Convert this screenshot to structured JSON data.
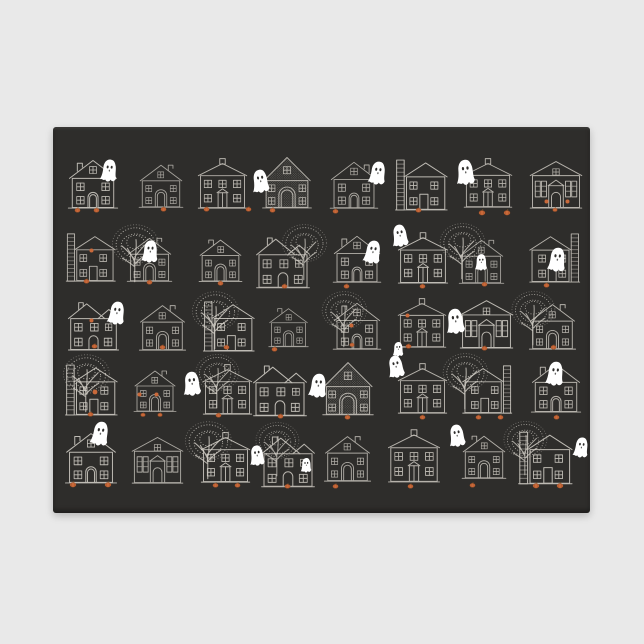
{
  "meta": {
    "description": "Product photo of a dark charcoal rectangular doormat on a light gray background, printed with a Halloween pattern: five rows of white sketched houses, bare speckled trees, white ghosts and orange pumpkins at the doorsteps."
  },
  "colors": {
    "page_bg": "#e9e9e9",
    "rug": "#2e2d2b",
    "line": "#d8d4cc",
    "ghost": "#ffffff",
    "eye": "#2e2d2b",
    "pumpkin": "#c9693a",
    "pumpkin_dark": "#8a4520",
    "stem": "#6e4f2e"
  },
  "rug": {
    "left": 53,
    "top": 127,
    "width": 537,
    "height": 386
  },
  "scene": {
    "width": 537,
    "height": 386,
    "items": [
      {
        "t": "houseA",
        "x": 12,
        "y": 29,
        "s": 56,
        "o": 0.85
      },
      {
        "t": "houseG",
        "x": 82,
        "y": 32,
        "s": 52,
        "o": 0.7
      },
      {
        "t": "houseB",
        "x": 142,
        "y": 30,
        "s": 55,
        "o": 0.8
      },
      {
        "t": "houseC",
        "x": 205,
        "y": 27,
        "s": 58,
        "o": 0.8
      },
      {
        "t": "houseA",
        "x": 274,
        "y": 31,
        "s": 54,
        "o": 0.75,
        "flip": true
      },
      {
        "t": "houseD",
        "x": 339,
        "y": 29,
        "s": 58,
        "o": 0.85
      },
      {
        "t": "houseB",
        "x": 408,
        "y": 30,
        "s": 54,
        "o": 0.8
      },
      {
        "t": "houseE",
        "x": 475,
        "y": 29,
        "s": 56,
        "o": 0.8
      },
      {
        "t": "pumpkin",
        "x": 21,
        "y": 80,
        "s": 7
      },
      {
        "t": "pumpkin",
        "x": 40,
        "y": 80,
        "s": 7
      },
      {
        "t": "pumpkin",
        "x": 107,
        "y": 79,
        "s": 7
      },
      {
        "t": "pumpkin",
        "x": 150,
        "y": 79,
        "s": 7
      },
      {
        "t": "pumpkin",
        "x": 192,
        "y": 79,
        "s": 7
      },
      {
        "t": "pumpkin",
        "x": 216,
        "y": 80,
        "s": 7
      },
      {
        "t": "pumpkin",
        "x": 279,
        "y": 81,
        "s": 7
      },
      {
        "t": "pumpkin",
        "x": 362,
        "y": 80,
        "s": 7
      },
      {
        "t": "pumpkin",
        "x": 425,
        "y": 82,
        "s": 8
      },
      {
        "t": "pumpkin",
        "x": 450,
        "y": 82,
        "s": 8
      },
      {
        "t": "pumpkin",
        "x": 499,
        "y": 80,
        "s": 6
      },
      {
        "t": "glow",
        "x": 491,
        "y": 72,
        "s": 5
      },
      {
        "t": "glow",
        "x": 512,
        "y": 72,
        "s": 5
      },
      {
        "t": "ghost",
        "x": 45,
        "y": 31,
        "s": 23,
        "rot": 6
      },
      {
        "t": "ghost",
        "x": 196,
        "y": 41,
        "s": 24,
        "rot": -8
      },
      {
        "t": "ghost",
        "x": 313,
        "y": 33,
        "s": 24,
        "rot": 8
      },
      {
        "t": "ghost",
        "x": 400,
        "y": 31,
        "s": 26,
        "rot": -5
      },
      {
        "t": "tree",
        "x": 52,
        "y": 94,
        "s": 62,
        "o": 0.8
      },
      {
        "t": "tree",
        "x": 222,
        "y": 94,
        "s": 60,
        "o": 0.75
      },
      {
        "t": "tree",
        "x": 380,
        "y": 93,
        "s": 60,
        "o": 0.8
      },
      {
        "t": "houseD",
        "x": 10,
        "y": 103,
        "s": 55,
        "o": 0.8
      },
      {
        "t": "houseG",
        "x": 70,
        "y": 105,
        "s": 53,
        "o": 0.75
      },
      {
        "t": "houseG",
        "x": 142,
        "y": 107,
        "s": 51,
        "o": 0.8,
        "flip": true
      },
      {
        "t": "houseF",
        "x": 200,
        "y": 105,
        "s": 60,
        "o": 0.8
      },
      {
        "t": "houseA",
        "x": 277,
        "y": 105,
        "s": 54,
        "o": 0.8
      },
      {
        "t": "houseB",
        "x": 342,
        "y": 104,
        "s": 56,
        "o": 0.85
      },
      {
        "t": "houseG",
        "x": 402,
        "y": 107,
        "s": 53,
        "o": 0.7
      },
      {
        "t": "houseD",
        "x": 474,
        "y": 103,
        "s": 56,
        "o": 0.8,
        "flip": true
      },
      {
        "t": "glow",
        "x": 36,
        "y": 121,
        "s": 5
      },
      {
        "t": "pumpkin",
        "x": 30,
        "y": 151,
        "s": 7
      },
      {
        "t": "pumpkin",
        "x": 93,
        "y": 152,
        "s": 7
      },
      {
        "t": "pumpkin",
        "x": 164,
        "y": 153,
        "s": 7
      },
      {
        "t": "pumpkin",
        "x": 228,
        "y": 156,
        "s": 7
      },
      {
        "t": "pumpkin",
        "x": 290,
        "y": 156,
        "s": 7
      },
      {
        "t": "pumpkin",
        "x": 366,
        "y": 156,
        "s": 7
      },
      {
        "t": "pumpkin",
        "x": 428,
        "y": 154,
        "s": 7
      },
      {
        "t": "pumpkin",
        "x": 490,
        "y": 155,
        "s": 7
      },
      {
        "t": "ghost",
        "x": 86,
        "y": 112,
        "s": 23,
        "rot": 4
      },
      {
        "t": "ghost",
        "x": 308,
        "y": 112,
        "s": 24,
        "rot": 10
      },
      {
        "t": "ghost",
        "x": 336,
        "y": 96,
        "s": 23,
        "rot": -8
      },
      {
        "t": "ghost",
        "x": 420,
        "y": 126,
        "s": 17,
        "rot": 0
      },
      {
        "t": "ghost",
        "x": 492,
        "y": 119,
        "s": 25,
        "rot": 6
      },
      {
        "t": "tree",
        "x": 132,
        "y": 161,
        "s": 62,
        "o": 0.8
      },
      {
        "t": "tree",
        "x": 262,
        "y": 161,
        "s": 60,
        "o": 0.75
      },
      {
        "t": "tree",
        "x": 452,
        "y": 161,
        "s": 58,
        "o": 0.75
      },
      {
        "t": "houseF",
        "x": 12,
        "y": 170,
        "s": 57,
        "o": 0.85
      },
      {
        "t": "houseG",
        "x": 82,
        "y": 172,
        "s": 55,
        "o": 0.75
      },
      {
        "t": "houseD",
        "x": 147,
        "y": 171,
        "s": 57,
        "o": 0.85
      },
      {
        "t": "houseG",
        "x": 212,
        "y": 176,
        "s": 47,
        "o": 0.7,
        "flip": true
      },
      {
        "t": "houseA",
        "x": 277,
        "y": 172,
        "s": 54,
        "o": 0.8
      },
      {
        "t": "houseB",
        "x": 342,
        "y": 170,
        "s": 54,
        "o": 0.8
      },
      {
        "t": "houseE",
        "x": 405,
        "y": 168,
        "s": 57,
        "o": 0.85
      },
      {
        "t": "houseG",
        "x": 472,
        "y": 171,
        "s": 55,
        "o": 0.8
      },
      {
        "t": "glow",
        "x": 36,
        "y": 191,
        "s": 5
      },
      {
        "t": "glow",
        "x": 296,
        "y": 196,
        "s": 5
      },
      {
        "t": "glow",
        "x": 352,
        "y": 186,
        "s": 5
      },
      {
        "t": "pumpkin",
        "x": 38,
        "y": 216,
        "s": 7
      },
      {
        "t": "pumpkin",
        "x": 106,
        "y": 217,
        "s": 7
      },
      {
        "t": "pumpkin",
        "x": 170,
        "y": 217,
        "s": 7
      },
      {
        "t": "pumpkin",
        "x": 218,
        "y": 219,
        "s": 7
      },
      {
        "t": "pumpkin",
        "x": 296,
        "y": 215,
        "s": 6
      },
      {
        "t": "pumpkin",
        "x": 352,
        "y": 216,
        "s": 7
      },
      {
        "t": "pumpkin",
        "x": 428,
        "y": 218,
        "s": 7
      },
      {
        "t": "pumpkin",
        "x": 497,
        "y": 217,
        "s": 7
      },
      {
        "t": "ghost",
        "x": 52,
        "y": 173,
        "s": 24,
        "rot": 8
      },
      {
        "t": "ghost",
        "x": 390,
        "y": 180,
        "s": 26,
        "rot": -6
      },
      {
        "t": "ghost",
        "x": 338,
        "y": 214,
        "s": 15,
        "rot": 0
      },
      {
        "t": "tree",
        "x": 3,
        "y": 224,
        "s": 62,
        "o": 0.8
      },
      {
        "t": "tree",
        "x": 136,
        "y": 224,
        "s": 58,
        "o": 0.75
      },
      {
        "t": "tree",
        "x": 383,
        "y": 223,
        "s": 60,
        "o": 0.8
      },
      {
        "t": "houseD",
        "x": 9,
        "y": 234,
        "s": 58,
        "o": 0.85
      },
      {
        "t": "houseG",
        "x": 77,
        "y": 238,
        "s": 50,
        "o": 0.75
      },
      {
        "t": "houseB",
        "x": 147,
        "y": 236,
        "s": 55,
        "o": 0.8
      },
      {
        "t": "houseF",
        "x": 197,
        "y": 233,
        "s": 60,
        "o": 0.85
      },
      {
        "t": "houseC",
        "x": 265,
        "y": 232,
        "s": 60,
        "o": 0.8
      },
      {
        "t": "houseB",
        "x": 342,
        "y": 235,
        "s": 55,
        "o": 0.8
      },
      {
        "t": "houseD",
        "x": 407,
        "y": 235,
        "s": 55,
        "o": 0.85,
        "flip": true
      },
      {
        "t": "houseA",
        "x": 475,
        "y": 233,
        "s": 56,
        "o": 0.8
      },
      {
        "t": "glow",
        "x": 39,
        "y": 262,
        "s": 6
      },
      {
        "t": "glow",
        "x": 84,
        "y": 265,
        "s": 5
      },
      {
        "t": "glow",
        "x": 101,
        "y": 265,
        "s": 5
      },
      {
        "t": "pumpkin",
        "x": 34,
        "y": 284,
        "s": 7
      },
      {
        "t": "pumpkin",
        "x": 87,
        "y": 285,
        "s": 6
      },
      {
        "t": "pumpkin",
        "x": 104,
        "y": 285,
        "s": 6
      },
      {
        "t": "pumpkin",
        "x": 162,
        "y": 285,
        "s": 7
      },
      {
        "t": "pumpkin",
        "x": 224,
        "y": 286,
        "s": 7
      },
      {
        "t": "pumpkin",
        "x": 291,
        "y": 287,
        "s": 7
      },
      {
        "t": "pumpkin",
        "x": 366,
        "y": 287,
        "s": 7
      },
      {
        "t": "pumpkin",
        "x": 422,
        "y": 287,
        "s": 7
      },
      {
        "t": "pumpkin",
        "x": 444,
        "y": 287,
        "s": 7
      },
      {
        "t": "pumpkin",
        "x": 500,
        "y": 287,
        "s": 7
      },
      {
        "t": "ghost",
        "x": 127,
        "y": 243,
        "s": 25,
        "rot": -5
      },
      {
        "t": "ghost",
        "x": 253,
        "y": 245,
        "s": 25,
        "rot": 6
      },
      {
        "t": "ghost",
        "x": 332,
        "y": 227,
        "s": 23,
        "rot": -10
      },
      {
        "t": "ghost",
        "x": 490,
        "y": 233,
        "s": 25,
        "rot": 6
      },
      {
        "t": "tree",
        "x": 125,
        "y": 291,
        "s": 62,
        "o": 0.8
      },
      {
        "t": "tree",
        "x": 196,
        "y": 292,
        "s": 58,
        "o": 0.7
      },
      {
        "t": "tree",
        "x": 444,
        "y": 291,
        "s": 58,
        "o": 0.75
      },
      {
        "t": "houseA",
        "x": 9,
        "y": 302,
        "s": 58,
        "o": 0.85
      },
      {
        "t": "houseE",
        "x": 77,
        "y": 305,
        "s": 55,
        "o": 0.75
      },
      {
        "t": "houseB",
        "x": 145,
        "y": 304,
        "s": 55,
        "o": 0.85
      },
      {
        "t": "houseF",
        "x": 205,
        "y": 304,
        "s": 60,
        "o": 0.8
      },
      {
        "t": "houseG",
        "x": 267,
        "y": 303,
        "s": 55,
        "o": 0.75
      },
      {
        "t": "houseB",
        "x": 332,
        "y": 301,
        "s": 58,
        "o": 0.8
      },
      {
        "t": "houseG",
        "x": 405,
        "y": 303,
        "s": 52,
        "o": 0.8,
        "flip": true
      },
      {
        "t": "houseD",
        "x": 462,
        "y": 301,
        "s": 60,
        "o": 0.85
      },
      {
        "t": "pumpkin",
        "x": 16,
        "y": 354,
        "s": 8
      },
      {
        "t": "pumpkin",
        "x": 51,
        "y": 354,
        "s": 8
      },
      {
        "t": "pumpkin",
        "x": 159,
        "y": 355,
        "s": 7
      },
      {
        "t": "pumpkin",
        "x": 181,
        "y": 355,
        "s": 7
      },
      {
        "t": "pumpkin",
        "x": 231,
        "y": 356,
        "s": 7
      },
      {
        "t": "pumpkin",
        "x": 279,
        "y": 356,
        "s": 7
      },
      {
        "t": "pumpkin",
        "x": 354,
        "y": 356,
        "s": 7
      },
      {
        "t": "pumpkin",
        "x": 416,
        "y": 355,
        "s": 7
      },
      {
        "t": "pumpkin",
        "x": 479,
        "y": 355,
        "s": 8
      },
      {
        "t": "pumpkin",
        "x": 503,
        "y": 355,
        "s": 8
      },
      {
        "t": "ghost",
        "x": 35,
        "y": 293,
        "s": 25,
        "rot": 10
      },
      {
        "t": "ghost",
        "x": 194,
        "y": 317,
        "s": 21,
        "rot": -6
      },
      {
        "t": "ghost",
        "x": 246,
        "y": 330,
        "s": 15,
        "rot": 0
      },
      {
        "t": "ghost",
        "x": 393,
        "y": 296,
        "s": 23,
        "rot": -8
      },
      {
        "t": "ghost",
        "x": 518,
        "y": 309,
        "s": 21,
        "rot": 8
      }
    ]
  }
}
